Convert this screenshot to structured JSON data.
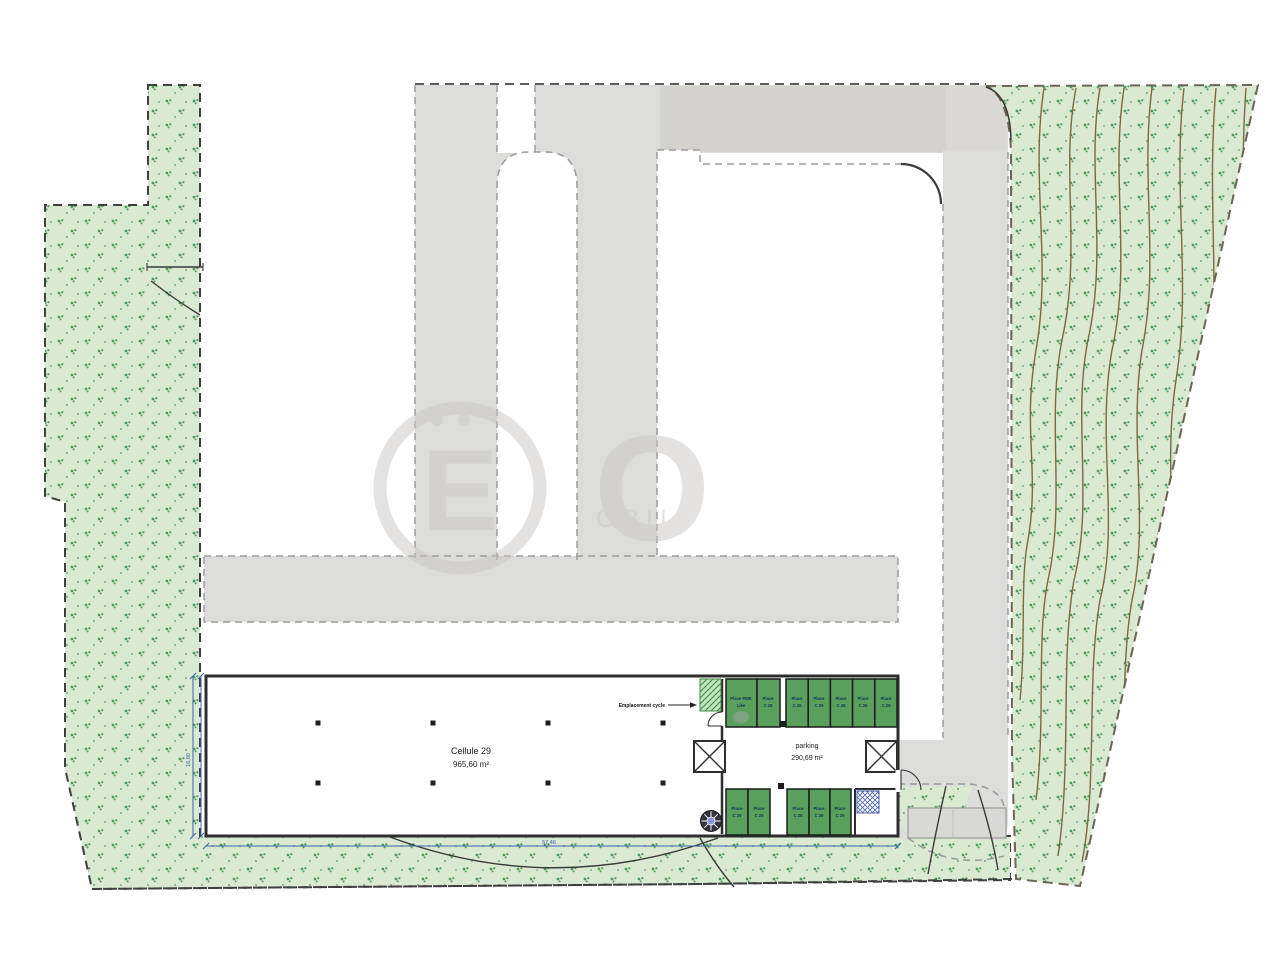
{
  "building": {
    "name": "Cellule 29",
    "area": "965,60 m²"
  },
  "parking": {
    "label": "parking",
    "area": "290,69 m²",
    "top_spaces": [
      {
        "l1": "Place PMR",
        "l2": "Liée"
      },
      {
        "l1": "Place",
        "l2": "C 29"
      },
      {
        "l1": "Place",
        "l2": "C 29"
      },
      {
        "l1": "Place",
        "l2": "C 29"
      },
      {
        "l1": "Place",
        "l2": "C 29"
      },
      {
        "l1": "Place",
        "l2": "C 29"
      },
      {
        "l1": "Place",
        "l2": "C 29"
      }
    ],
    "bottom_spaces": [
      {
        "l1": "Place",
        "l2": "C 29"
      },
      {
        "l1": "Place",
        "l2": "C 29"
      },
      {
        "l1": "Place",
        "l2": "C 29"
      },
      {
        "l1": "Place",
        "l2": "C 29"
      },
      {
        "l1": "Place",
        "l2": "C 29"
      }
    ]
  },
  "cycle": {
    "label": "Emplacement cycle"
  },
  "dimensions": {
    "width": "57,46",
    "height": "16,80"
  },
  "watermark": {
    "initial": "E",
    "letter": "O",
    "caption": "OBIL"
  },
  "colors": {
    "vegetation": "#d9e9d2",
    "vegetation_mark": "#4f9b58",
    "parking_space": "#58a05b",
    "road": "#dcdcda",
    "road_dark": "#d2cfca",
    "wall": "#2e2e2e",
    "boundary": "#3f3f3f",
    "dimension": "#3a62b0",
    "contour": "#7d6840"
  }
}
